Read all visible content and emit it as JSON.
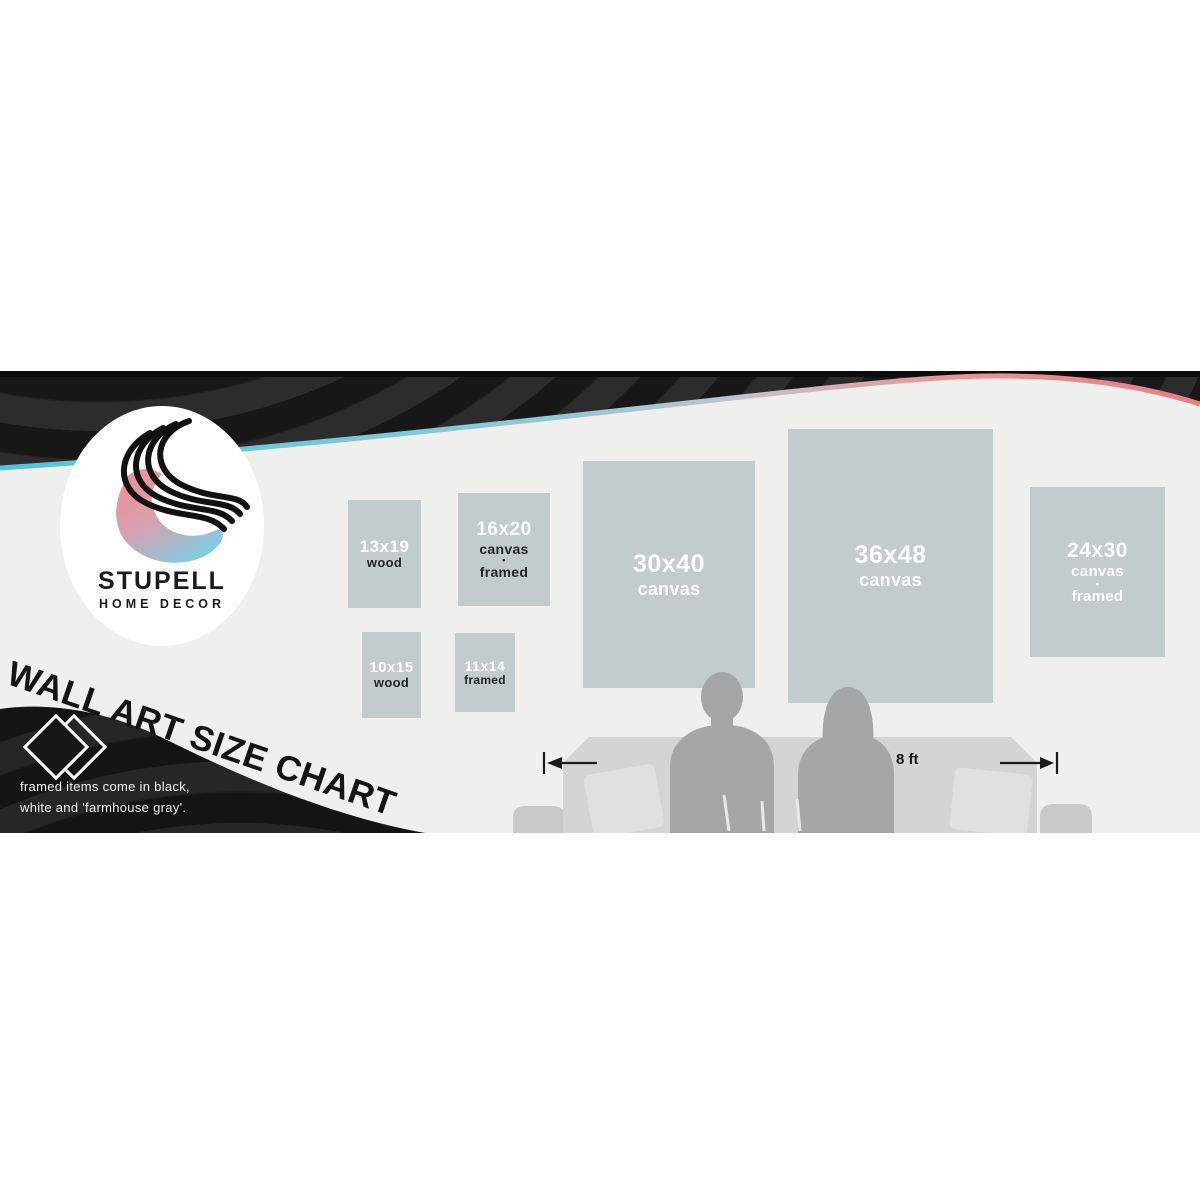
{
  "banner": {
    "logo": {
      "brand": "STUPELL",
      "subtitle": "HOME DECOR"
    },
    "title": "WALL ART SIZE CHART",
    "caption": {
      "line1": "framed items come in black,",
      "line2": "white and 'farmhouse gray'."
    },
    "scale_label": "8 ft",
    "boxes": [
      {
        "size": "13x19",
        "lines": [
          "wood"
        ]
      },
      {
        "size": "16x20",
        "lines": [
          "canvas",
          "•",
          "framed"
        ]
      },
      {
        "size": "10x15",
        "lines": [
          "wood"
        ]
      },
      {
        "size": "11x14",
        "lines": [
          "framed"
        ]
      },
      {
        "size": "30x40",
        "lines": [
          "canvas"
        ]
      },
      {
        "size": "36x48",
        "lines": [
          "canvas"
        ]
      },
      {
        "size": "24x30",
        "lines": [
          "canvas",
          "•",
          "framed"
        ]
      }
    ],
    "colors": {
      "wave_cyan": "#54c4d8",
      "wave_coral": "#e87e84",
      "logo_pink": "#ef8f94",
      "logo_blue": "#79d0e5",
      "box_fill": "#c3cccd",
      "dark_swoosh": "#1c1c1c"
    }
  }
}
